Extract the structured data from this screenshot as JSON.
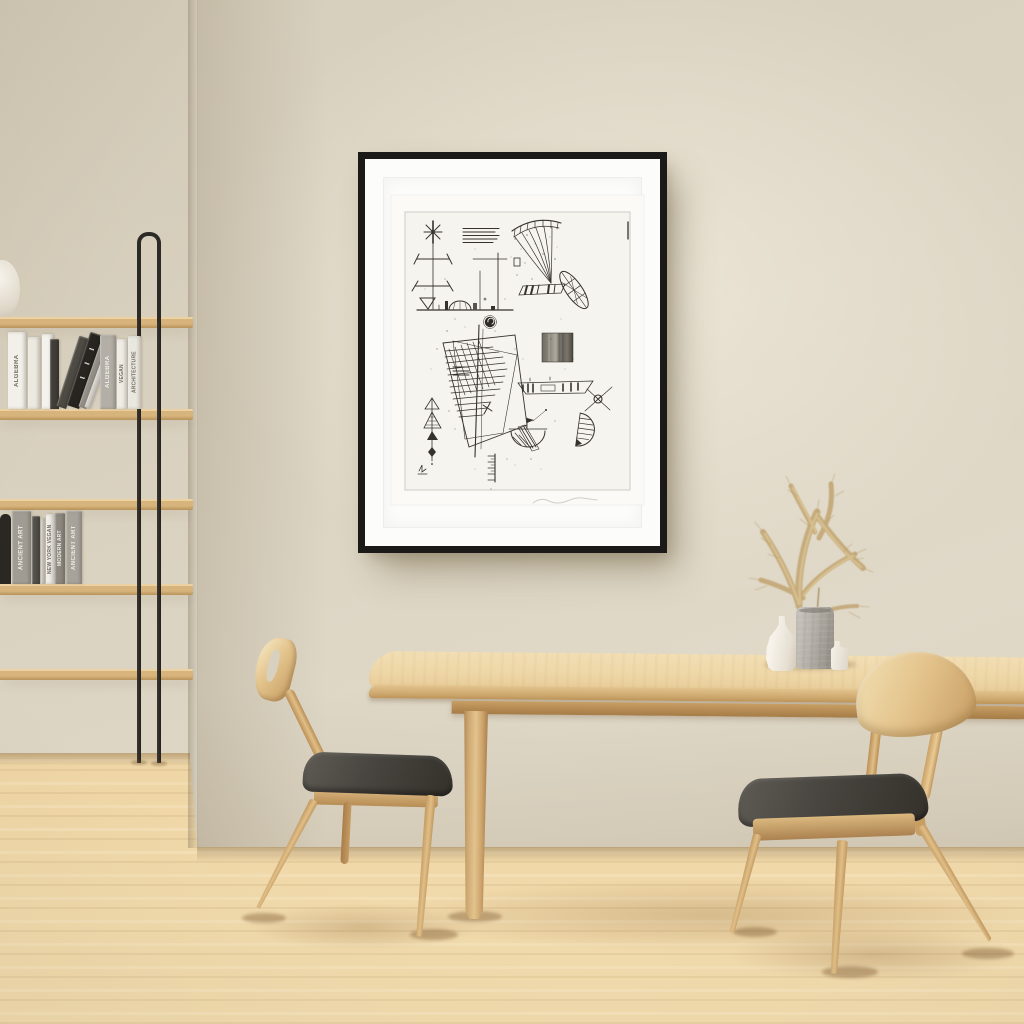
{
  "scene": {
    "description": "Minimalist dining room interior: beige walls, black-framed abstract etching on the wall, oak ladder bookshelf with books, light oak dining table with two wooden chairs with charcoal upholstered seats, vases with dried pampas grass on the table, light wood plank floor",
    "lighting": "soft daylight from upper left"
  },
  "palette": {
    "wall": "#dcd4c3",
    "alcove_wall": "#d5cdbb",
    "floor_light": "#f0d8aa",
    "floor_dark": "#d9ba85",
    "shelf_wood": "#d3b07a",
    "metal_frame": "#2c2a26",
    "table_wood": "#ecd5a6",
    "chair_wood": "#dfbe86",
    "cushion": "#44403a",
    "art_frame": "#1b1a18",
    "art_mat": "#fcfcfb",
    "ink": "#35322d",
    "concrete_vase": "#b3afa7",
    "ceramic_vase": "#f2eee6",
    "pampas": "#c2a673"
  },
  "artwork": {
    "style": "black-and-white abstract line etching with scattered geometric motifs, plate mark and faint pencil signature",
    "frame": "thin black gallery frame with wide white mat"
  },
  "bookshelf": {
    "shelf_count": 5,
    "frame_material": "black metal side frame",
    "row1_books": [
      {
        "label": "ALGEBRA"
      },
      {
        "label": ""
      },
      {
        "label": ""
      },
      {
        "label": ""
      },
      {
        "label": ""
      },
      {
        "label": ""
      },
      {
        "label": ""
      },
      {
        "label": ""
      },
      {
        "label": "ALGEBRA"
      },
      {
        "label": "VEGAN"
      },
      {
        "label": "ARCHITECTURE"
      }
    ],
    "row2_books": [
      {
        "label": "ANCIENT ART"
      },
      {
        "label": ""
      },
      {
        "label": ""
      },
      {
        "label": "NEW YORK VEGAN"
      },
      {
        "label": "MODERN ART"
      },
      {
        "label": "ANCIENT ART"
      }
    ]
  },
  "furniture": {
    "table": "light oak dining table",
    "chair_left": "oak side chair with charcoal seat, profile view",
    "chair_right": "oak side chair with charcoal seat, rear view"
  },
  "tabletop_items": {
    "vase_1": "white ceramic bottle vase",
    "vase_2": "concrete cylinder vase with dried pampas grass",
    "vase_3": "small white ceramic vase"
  }
}
